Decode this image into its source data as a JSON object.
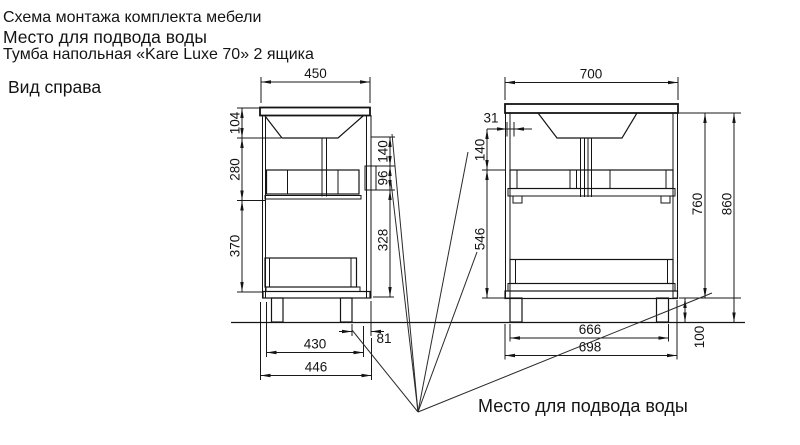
{
  "header": {
    "line1": "Схема монтажа комплекта мебели",
    "line2": "Место для подвода воды",
    "line3": "Тумба напольная «Kare Luxe 70» 2 ящика",
    "view_label": "Вид справа"
  },
  "side_view": {
    "width_top": "450",
    "left_heights": {
      "basin": "104",
      "upper": "280",
      "lower": "370"
    },
    "right_heights": {
      "to_zone": "140",
      "zone": "96",
      "below_zone": "328"
    },
    "bottom_dims": {
      "leg_offset": "81",
      "inner_depth": "430",
      "outer_depth": "446"
    }
  },
  "front_view": {
    "width_top": "700",
    "zone_offset": "31",
    "left_heights": {
      "to_zone": "140",
      "below_zone": "546"
    },
    "right_heights": {
      "body": "760",
      "total": "860",
      "legs": "100"
    },
    "bottom_dims": {
      "legs_span": "666",
      "body_width": "698"
    }
  },
  "annotation": {
    "water_supply": "Место для подвода воды"
  }
}
